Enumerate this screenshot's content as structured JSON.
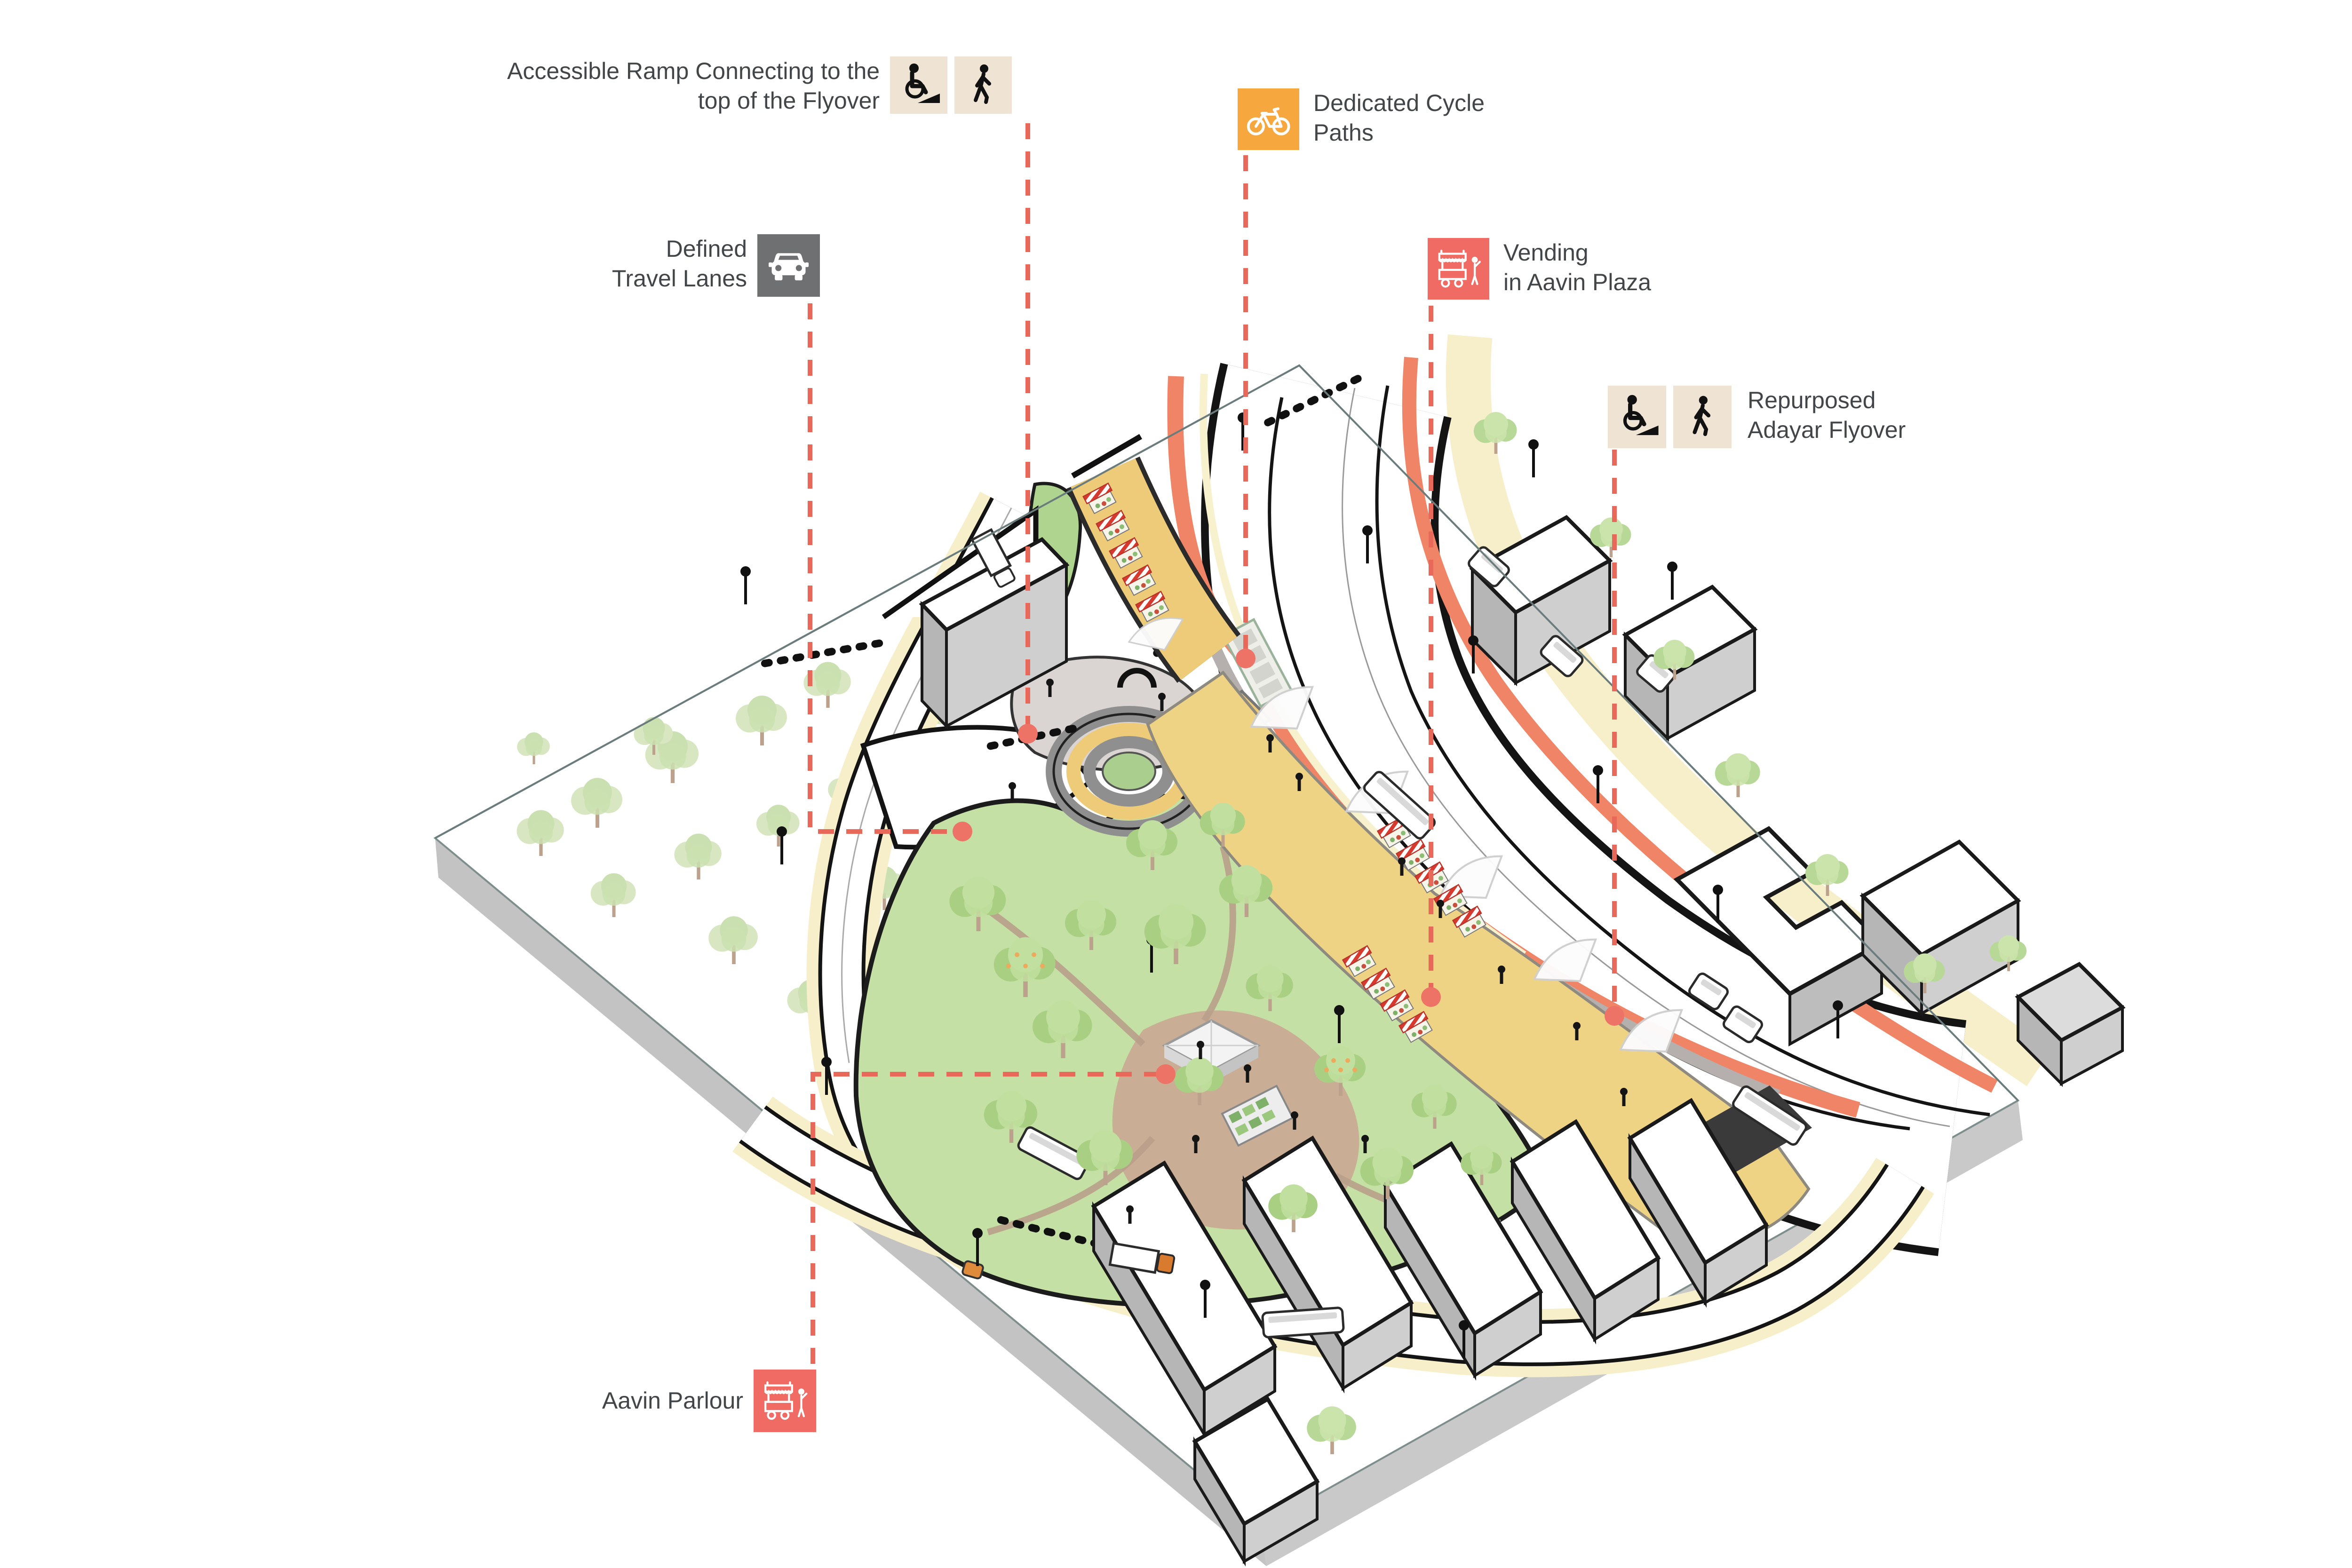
{
  "diagram_title": "Repurposed Adayar Flyover — axonometric urban design diagram",
  "labels": {
    "accessible_ramp": {
      "line1": "Accessible Ramp Connecting to the",
      "line2": "top of the Flyover",
      "icons": [
        "wheelchair-ramp-icon",
        "pedestrian-icon"
      ]
    },
    "cycle_paths": {
      "line1": "Dedicated Cycle",
      "line2": "Paths",
      "icons": [
        "bicycle-icon"
      ]
    },
    "travel_lanes": {
      "line1": "Defined",
      "line2": "Travel Lanes",
      "icons": [
        "car-icon"
      ]
    },
    "vending": {
      "line1": "Vending",
      "line2": "in Aavin Plaza",
      "icons": [
        "vending-cart-icon"
      ]
    },
    "repurposed_flyover": {
      "line1": "Repurposed",
      "line2": "Adayar Flyover",
      "icons": [
        "wheelchair-ramp-icon",
        "pedestrian-icon"
      ]
    },
    "aavin_parlour": {
      "line1": "Aavin Parlour",
      "icons": [
        "vending-cart-icon"
      ]
    }
  },
  "theme": {
    "colors": {
      "label-text": "#424649",
      "tile-beige": "#EFE3D3",
      "tile-orange": "#F6A83F",
      "tile-gray": "#6E7072",
      "tile-red": "#EF6B64",
      "leader": "#E8685A",
      "leader-dot": "#ED7366",
      "plaza-yellow": "#EFD385",
      "flyover-yellow": "#EDCB79",
      "cycle-lane-orange": "#EF8467",
      "park-green": "#C4E0A4",
      "site-base-gray": "#C3C3C3",
      "sidewalk-cream": "#F6EFC9"
    }
  }
}
